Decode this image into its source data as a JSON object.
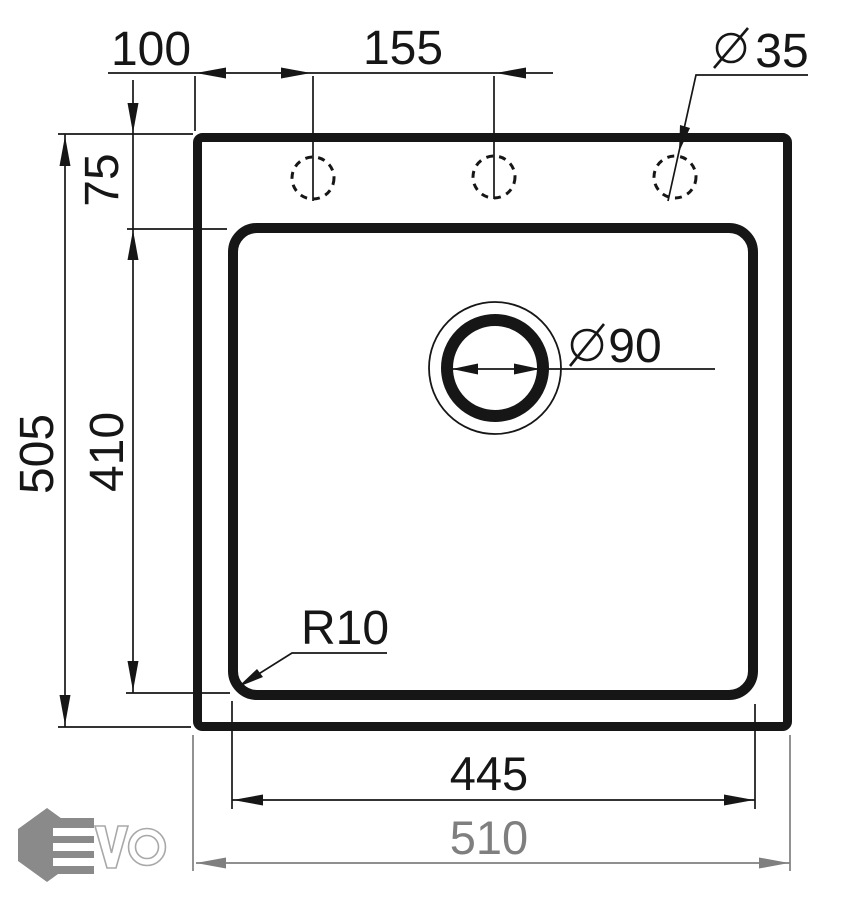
{
  "drawing": {
    "kind": "sink-dimension-drawing",
    "dimensions": {
      "edge_to_first_hole": "100",
      "hole_spacing": "155",
      "tap_hole_diameter": "35",
      "rim_to_bowl_top": "75",
      "overall_depth": "505",
      "bowl_depth": "410",
      "drain_diameter": "90",
      "corner_radius": "R10",
      "bowl_width": "445",
      "overall_width": "510"
    },
    "symbols": {
      "diameter_symbol": "Ø"
    },
    "colors": {
      "line": "#161616",
      "secondary_dimension": "#7f7f7f",
      "logo_gray": "#8a8a8a"
    },
    "logo": {
      "brand": "EVO"
    }
  }
}
